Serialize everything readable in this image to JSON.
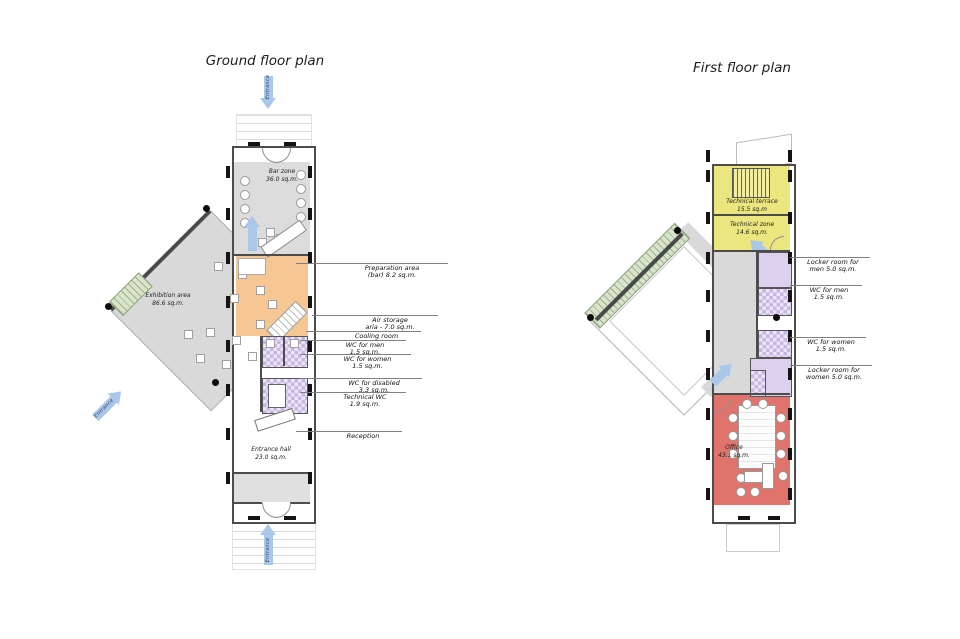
{
  "ground": {
    "title": "Ground floor plan",
    "arrows": {
      "top": "Entrance",
      "side": "Entrance",
      "bottom": "Entrance"
    },
    "rooms": {
      "bar_zone": "Bar zone\n36.0 sq.m.",
      "exhibition": "Exhibition area\n86.6 sq.m.",
      "entrance_hall": "Entrance hall\n23.0 sq.m."
    },
    "annotations": [
      "Preparation area\n(bar) 8.2 sq.m.",
      "Air storage\naria - 7.0 sq.m.",
      "Cooling room",
      "WC for men\n1.5 sq.m.",
      "WC for women\n1.5 sq.m.",
      "WC for disabled\n3.3 sq.m.",
      "Technical WC\n1.9 sq.m.",
      "Reception"
    ]
  },
  "first": {
    "title": "First floor plan",
    "rooms": {
      "technical_terrace": "Technical terrace\n15.5 sq.m",
      "technical_zone": "Technical zone\n14.6 sq.m.",
      "office": "Office\n43.1 sq.m."
    },
    "annotations": [
      "Locker room for\nmen 5.0 sq.m.",
      "WC for men\n1.5 sq.m.",
      "WC for women\n1.5 sq.m.",
      "Locker room for\nwomen 5.0 sq.m."
    ]
  },
  "palette": {
    "plan_gray": "#d9d9d9",
    "orange": "#f6c693",
    "purple": "#dcd0ee",
    "yellow": "#ece67e",
    "red": "#e0736c",
    "green": "#d8e5c8",
    "arrow_blue": "#a9c7e8",
    "wall_dark": "#4c4c4c"
  }
}
